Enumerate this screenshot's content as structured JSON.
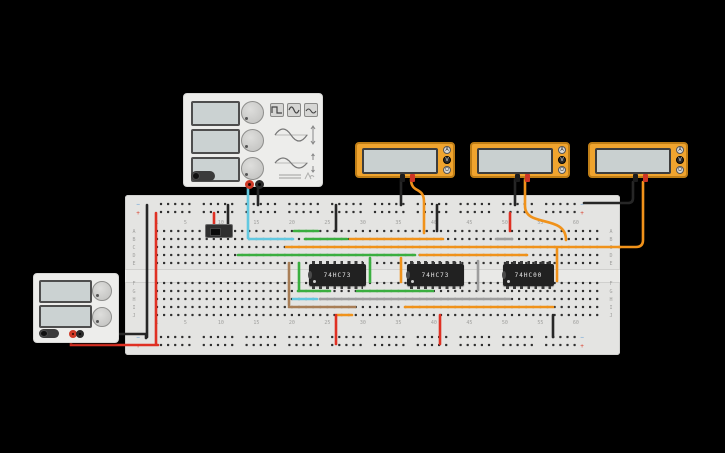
{
  "scene": {
    "background": "#000000"
  },
  "breadboard": {
    "row_letters_top": [
      "A",
      "B",
      "C",
      "D",
      "E"
    ],
    "row_letters_bottom": [
      "F",
      "G",
      "H",
      "I",
      "J"
    ],
    "column_numbers": [
      1,
      5,
      10,
      15,
      20,
      25,
      30,
      35,
      40,
      45,
      50,
      55,
      60
    ],
    "rail_negative_symbol": "−",
    "rail_positive_symbol": "+",
    "rail_negative_color": "#5b9bd5",
    "rail_positive_color": "#d9402e",
    "label_color": "#9f9f9d",
    "hole_color": "#2f2f2f",
    "columns": 63
  },
  "ics": [
    {
      "label": "74HC73",
      "x": 309,
      "w": 57
    },
    {
      "label": "74HC73",
      "x": 407,
      "w": 57
    },
    {
      "label": "74HC00",
      "x": 503,
      "w": 51
    }
  ],
  "multimeter": {
    "buttons": [
      "A",
      "V",
      "Ω"
    ],
    "active_button": "V",
    "units": [
      {
        "x": 355
      },
      {
        "x": 470
      },
      {
        "x": 588
      }
    ],
    "body_color": "#f0a42e"
  },
  "wire_colors": {
    "red": "#df3023",
    "black": "#262626",
    "cyan": "#62c8e0",
    "green": "#3aae3f",
    "orange": "#f0921a",
    "gray": "#9e9e9e",
    "brown": "#a87e56"
  },
  "wires": [
    {
      "color": "black",
      "d": "M78,334 H146 V338"
    },
    {
      "color": "red",
      "d": "M71,334 V345 H158"
    },
    {
      "color": "black",
      "d": "M147,205 V337"
    },
    {
      "color": "red",
      "d": "M156,213 V344"
    },
    {
      "color": "red",
      "d": "M214,213 V229"
    },
    {
      "color": "black",
      "d": "M228,205 V229"
    },
    {
      "color": "cyan",
      "d": "M248,186 V238"
    },
    {
      "color": "black",
      "d": "M258,186 V205"
    },
    {
      "color": "cyan",
      "d": "M249,239 H293"
    },
    {
      "color": "green",
      "d": "M294,231 H318"
    },
    {
      "color": "green",
      "d": "M305,239 H347"
    },
    {
      "color": "orange",
      "d": "M350,239 H443"
    },
    {
      "color": "gray",
      "d": "M496,239 H512"
    },
    {
      "color": "orange",
      "d": "M286,247 H620"
    },
    {
      "color": "orange",
      "d": "M643,182 V240 Q643,247 636,247 H619"
    },
    {
      "color": "green",
      "d": "M238,255 H415"
    },
    {
      "color": "orange",
      "d": "M420,255 H527"
    },
    {
      "color": "black",
      "d": "M336,205 V231"
    },
    {
      "color": "black",
      "d": "M437,205 V231"
    },
    {
      "color": "red",
      "d": "M510,213 V231"
    },
    {
      "color": "black",
      "d": "M401,179 V205"
    },
    {
      "color": "orange",
      "d": "M411,179 C411,194 424,186 424,202 V233"
    },
    {
      "color": "black",
      "d": "M515,179 V205"
    },
    {
      "color": "orange",
      "d": "M525,179 V206 C525,228 566,214 566,240"
    },
    {
      "color": "black",
      "d": "M633,182 V198 Q633,203 628,203 H584"
    },
    {
      "color": "brown",
      "d": "M289,263 V305"
    },
    {
      "color": "green",
      "d": "M299,263 V290"
    },
    {
      "color": "green",
      "d": "M370,258 V282"
    },
    {
      "color": "orange",
      "d": "M401,258 V282"
    },
    {
      "color": "gray",
      "d": "M478,261 V290"
    },
    {
      "color": "orange",
      "d": "M557,249 V281"
    },
    {
      "color": "green",
      "d": "M298,291 H330"
    },
    {
      "color": "green",
      "d": "M357,291 H433"
    },
    {
      "color": "cyan",
      "d": "M293,299 H317"
    },
    {
      "color": "gray",
      "d": "M320,299 H510"
    },
    {
      "color": "brown",
      "d": "M289,307 H355"
    },
    {
      "color": "orange",
      "d": "M405,307 H553"
    },
    {
      "color": "orange",
      "d": "M337,315 H352"
    },
    {
      "color": "red",
      "d": "M336,315 V344"
    },
    {
      "color": "red",
      "d": "M440,315 V344"
    },
    {
      "color": "black",
      "d": "M553,315 V337"
    }
  ]
}
